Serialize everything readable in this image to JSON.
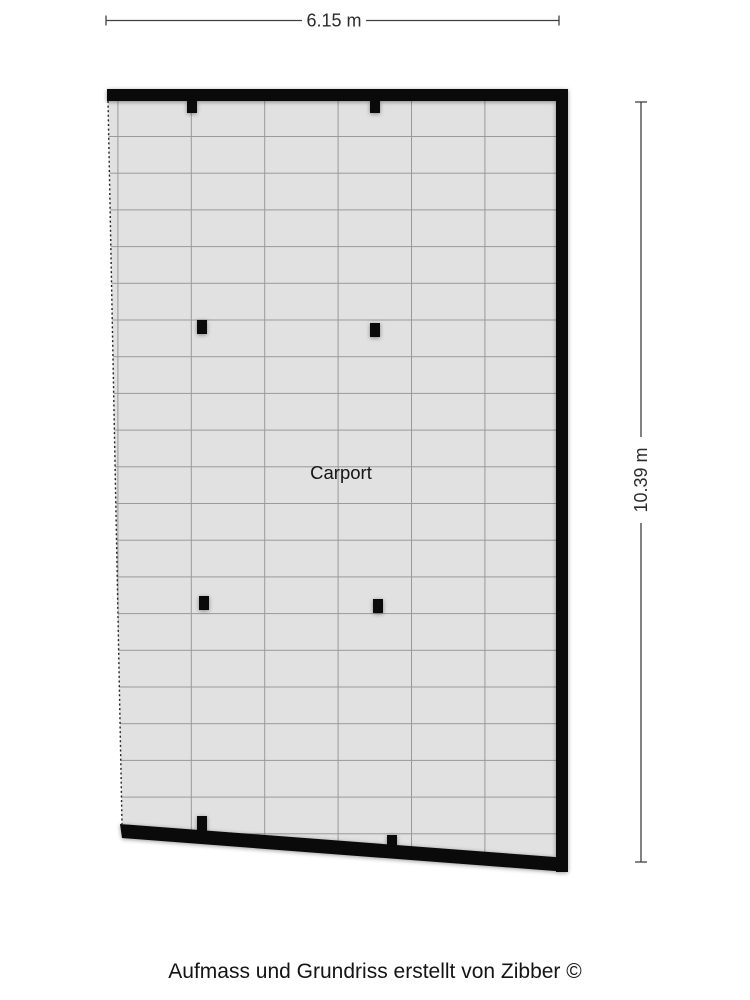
{
  "floorplan": {
    "room_label": "Carport",
    "dimensions": {
      "width_label": "6.15 m",
      "height_label": "10.39 m"
    }
  },
  "footer": {
    "credit": "Aufmass und Grundriss erstellt von Zibber ©"
  },
  "colors": {
    "background": "#ffffff",
    "floor_fill": "#e1e1e1",
    "grid_line": "#999999",
    "wall": "#0a0a0a",
    "dimension_line": "#404040",
    "label_text": "#141414"
  }
}
